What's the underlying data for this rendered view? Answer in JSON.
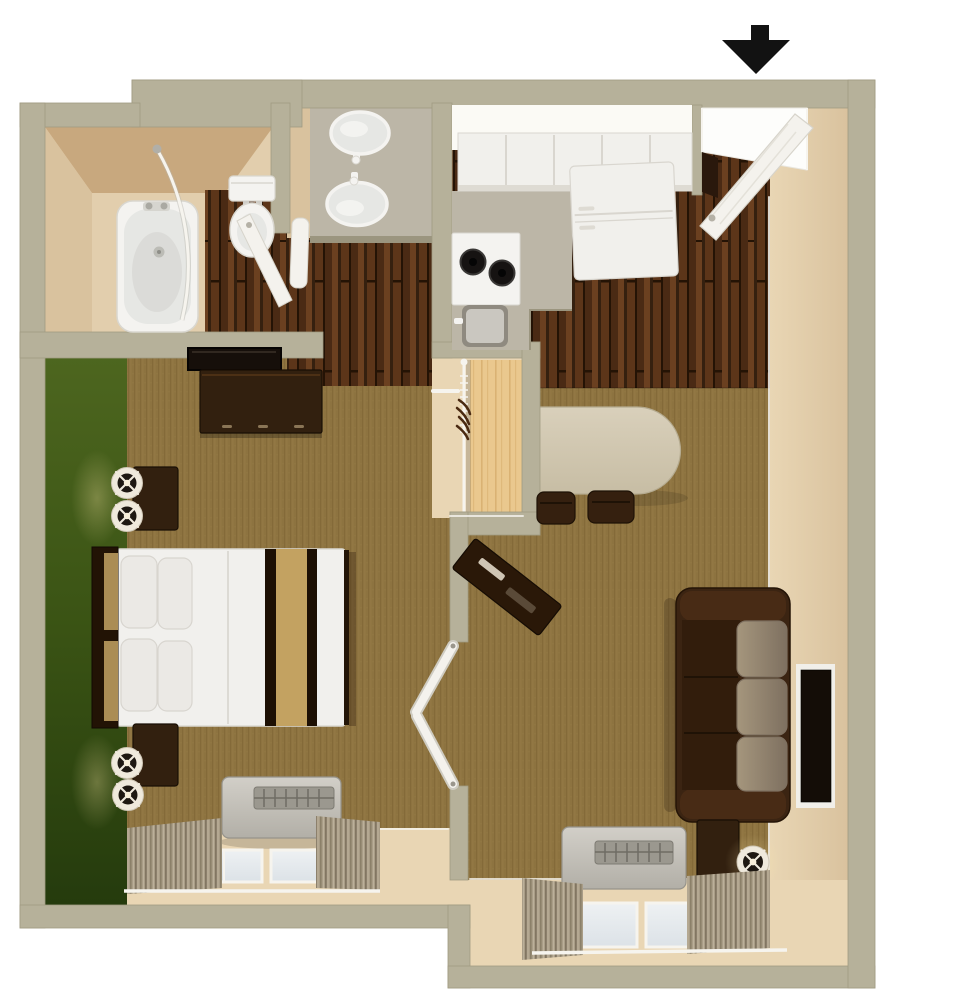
{
  "scene": {
    "type": "3d-floor-plan-top-view",
    "subject": "studio suite with bedroom, bathroom, vanity, kitchen and living-dining area",
    "indicators": {
      "entry_arrow": {
        "shape": "arrow-down",
        "color": "#121212"
      }
    }
  },
  "rooms": [
    {
      "name": "bathroom",
      "floor": "wood-and-tan",
      "items": [
        "bathtub",
        "shower-curtain-rod",
        "shower-head",
        "toilet",
        "bathroom-door"
      ]
    },
    {
      "name": "vanity-area",
      "floor": "wood",
      "items": [
        "counter",
        "sink-left",
        "sink-right",
        "faucets",
        "towel"
      ]
    },
    {
      "name": "kitchen",
      "floor": "wood",
      "items": [
        "upper-cabinets",
        "countertop",
        "stove-two-burners",
        "kitchen-sink",
        "refrigerator"
      ]
    },
    {
      "name": "entry",
      "floor": "wood",
      "items": [
        "open-entry-door",
        "door-knob",
        "threshold"
      ]
    },
    {
      "name": "closet",
      "floor": "tan",
      "items": [
        "closet-shelf",
        "hanging-rod",
        "hangers"
      ]
    },
    {
      "name": "bedroom",
      "floor": "carpet",
      "items": [
        "green-accent-wall",
        "wall-mirror",
        "dresser",
        "bed",
        "headboard",
        "pillows",
        "bed-runner",
        "nightstand-upper",
        "nightstand-lower",
        "table-lamps",
        "ptac-unit",
        "window",
        "curtains",
        "curtain-rod"
      ]
    },
    {
      "name": "living-dining",
      "floor": "carpet",
      "items": [
        "oval-dining-table",
        "dining-chair-left",
        "dining-chair-right",
        "angled-tv-console",
        "double-doors",
        "sofa",
        "wall-tv",
        "side-table",
        "table-lamp",
        "ptac-unit",
        "window",
        "curtains",
        "curtain-rod"
      ]
    }
  ],
  "colors": {
    "white": "#ffffff",
    "wall": "#b6b19a",
    "wall_edge": "#a09b82",
    "face_light": "#e9d6b4",
    "face_mid": "#d9c29e",
    "face_dark": "#c8a87e",
    "bath_floor": "#e2cead",
    "green_top": "#4d661f",
    "green_mid": "#3a5314",
    "green_bottom": "#253b0d",
    "carpet": "#8d7340",
    "carpet_dark": "#7c6333",
    "carpet_light": "#9d824d",
    "wood_a": "#5c3519",
    "wood_b": "#4a2a14",
    "wood_c": "#6b4020",
    "wood_d": "#35200f",
    "wood_seam": "#241305",
    "glow": "#fbfaf5",
    "cabinet": "#f1f0ec",
    "cabinet_seam": "#d9d6cf",
    "cabinet_shadow": "#dedbd3",
    "counter": "#bcb6a7",
    "counter_edge": "#9b957f",
    "fixture": "#f4f3f0",
    "fixture_stroke": "#d9d7d0",
    "basin": "#e6e7e4",
    "basin_deep": "#d8d8d4",
    "burner": "#161312",
    "sink_rim": "#8f8a80",
    "sink_basin": "#cac7c0",
    "table": "#d9d0bb",
    "table_dark": "#c7bda4",
    "table_edge": "#b5ab90",
    "chair": "#35200f",
    "chair_edge": "#1e1206",
    "sofa_frame": "#3b2412",
    "sofa_arm": "#482b15",
    "sofa_seat": "#321d0c",
    "cushion": "#a5967d",
    "cushion_edge": "#7e7060",
    "furniture": "#32200f",
    "furniture_edge": "#190f05",
    "furniture_hi": "#4c3015",
    "mirror": "#160f0a",
    "lamp_shade": "#efe9dc",
    "lamp_ring": "#cfc7b6",
    "lamp_core": "#1e1812",
    "lamp_center": "#f7eed9",
    "ac_top": "#d2cfc8",
    "ac_bottom": "#b2afa7",
    "ac_edge": "#96938b",
    "grille": "#9b988f",
    "grille_slat": "#6f6c64",
    "pane_a": "#eef1f3",
    "pane_b": "#dce2e7",
    "curt_a": "#a99d87",
    "curt_b": "#8b8069",
    "curt_c": "#bbb09a",
    "curt_d": "#786d59",
    "rod": "#f6f4ee",
    "door": "#f4f2ed",
    "door_edge": "#d7d4cb",
    "opening": "#fdfdfb",
    "threshold_dark": "#2a180c",
    "arrow": "#121212",
    "shelf_a": "#eac88e",
    "shelf_b": "#d3a968",
    "tv": "#140d07",
    "tv_frame": "#f1efe9",
    "runner": "#c3a261",
    "runner_dark": "#1d1004",
    "linen": "#f1f0ed",
    "linen_edge": "#dcdad4",
    "pillow": "#ebe9e5",
    "pillow_edge": "#d8d5cf",
    "bedframe": "#221305",
    "headboard_panel": "#ab8d55",
    "glow_warm": "#ffe9a8"
  }
}
